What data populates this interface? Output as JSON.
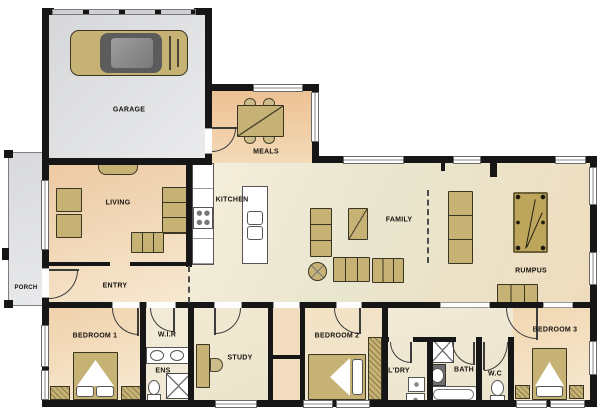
{
  "rooms": {
    "garage": "GARAGE",
    "meals": "MEALS",
    "kitchen": "KITCHEN",
    "living": "LIVING",
    "entry": "ENTRY",
    "porch": "PORCH",
    "family": "FAMILY",
    "rumpus": "RUMPUS",
    "bedroom1": "BEDROOM 1",
    "wir": "W.I.R",
    "ens": "ENS",
    "study": "STUDY",
    "bedroom2": "BEDROOM 2",
    "laundry": "L'DRY",
    "bath": "BATH",
    "wc": "W.C",
    "bedroom3": "BEDROOM 3"
  },
  "colors": {
    "wall": "#161616",
    "furniture_tan": "#c7b276",
    "warm_floor": "#eecaa2",
    "cool_floor": "#e9e6cf",
    "garage_floor": "#dcddde"
  }
}
